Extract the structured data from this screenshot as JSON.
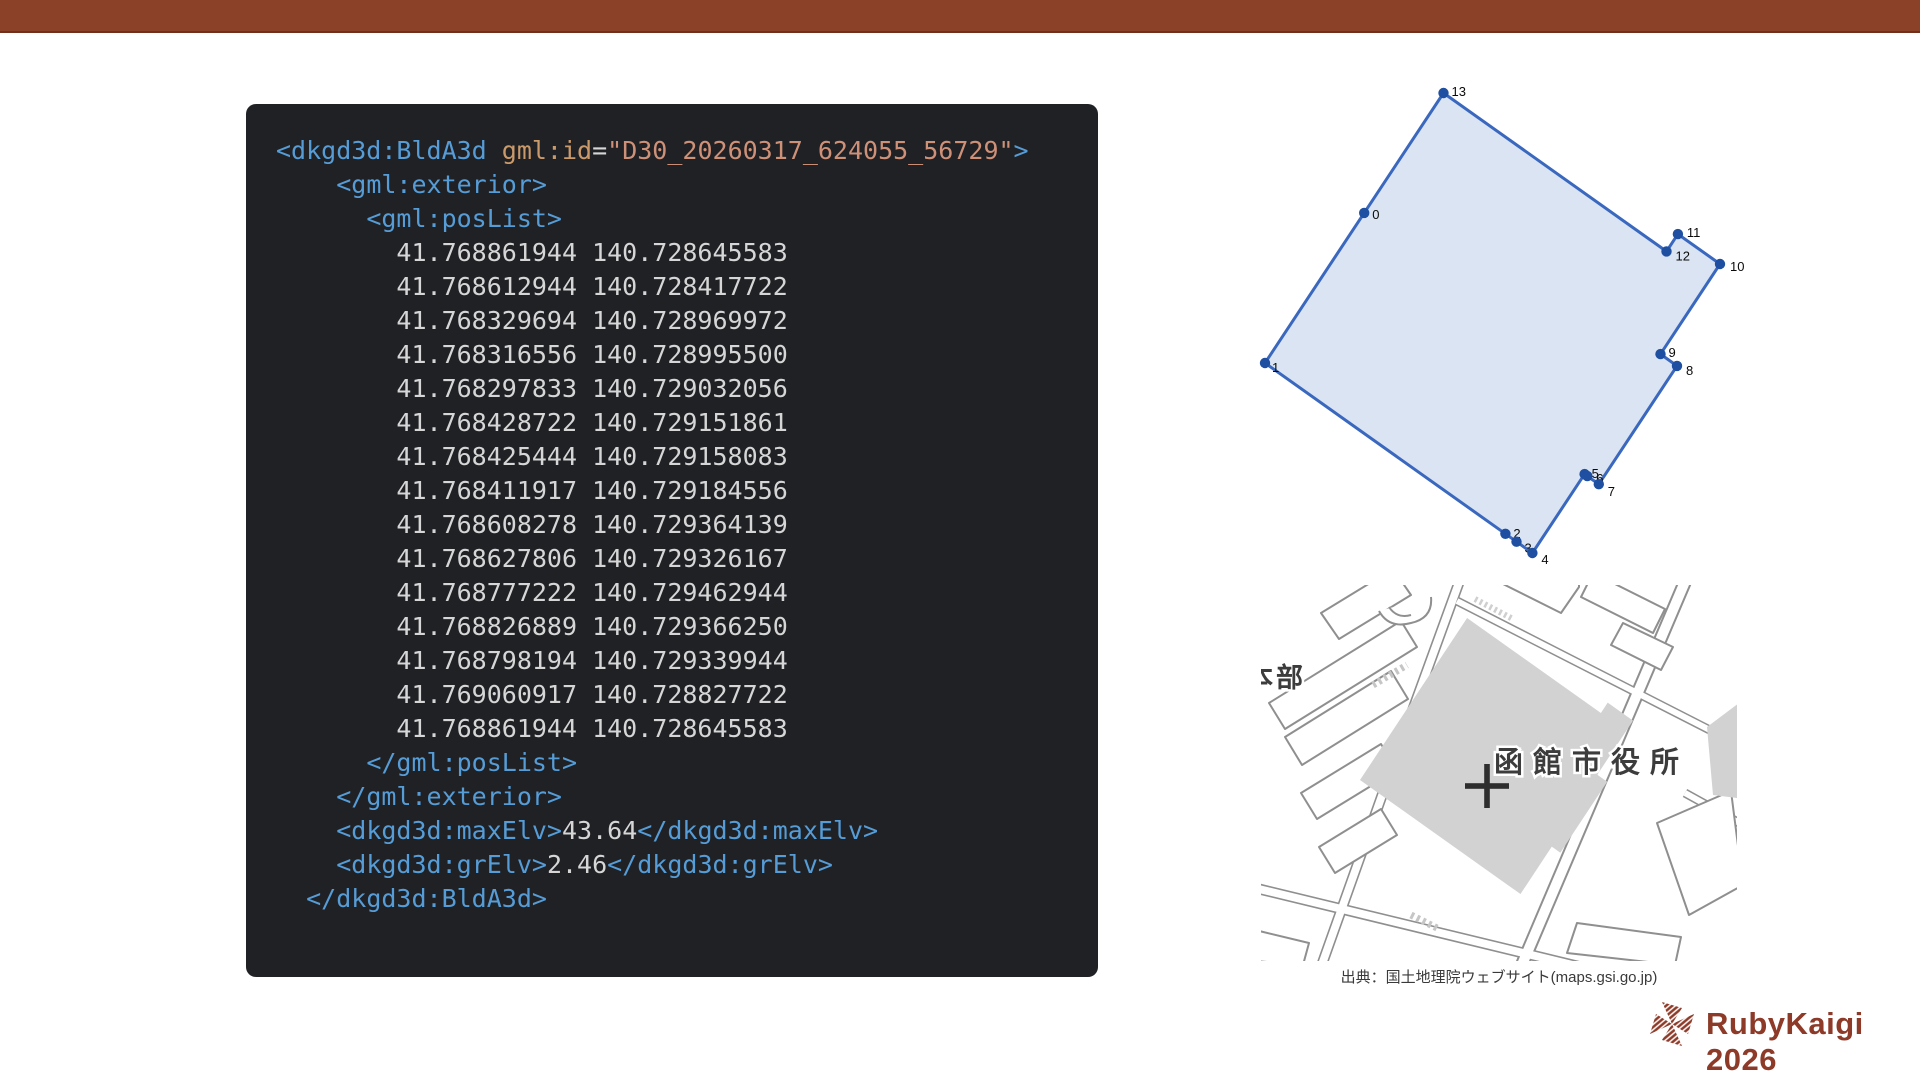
{
  "slide": {
    "background": "#FFFFFF",
    "top_bar_color": "#8B4127",
    "top_bar_edge_color": "#72301C"
  },
  "code_block": {
    "background": "#1F2125",
    "token_colors": {
      "tag": "#569CD6",
      "attr_name": "#CB9A6B",
      "string": "#CE9178",
      "plain": "#D6D6D6"
    },
    "lines": [
      [
        [
          "tag",
          "<dkgd3d:BldA3d"
        ],
        [
          "pl",
          " "
        ],
        [
          "attr",
          "gml:id"
        ],
        [
          "pl",
          "="
        ],
        [
          "str",
          "\"D30_20260317_624055_56729\""
        ],
        [
          "tag",
          ">"
        ]
      ],
      [
        [
          "pl",
          "    "
        ],
        [
          "tag",
          "<gml:exterior>"
        ]
      ],
      [
        [
          "pl",
          "      "
        ],
        [
          "tag",
          "<gml:posList>"
        ]
      ],
      [
        [
          "pl",
          "        41.768861944 140.728645583"
        ]
      ],
      [
        [
          "pl",
          "        41.768612944 140.728417722"
        ]
      ],
      [
        [
          "pl",
          "        41.768329694 140.728969972"
        ]
      ],
      [
        [
          "pl",
          "        41.768316556 140.728995500"
        ]
      ],
      [
        [
          "pl",
          "        41.768297833 140.729032056"
        ]
      ],
      [
        [
          "pl",
          "        41.768428722 140.729151861"
        ]
      ],
      [
        [
          "pl",
          "        41.768425444 140.729158083"
        ]
      ],
      [
        [
          "pl",
          "        41.768411917 140.729184556"
        ]
      ],
      [
        [
          "pl",
          "        41.768608278 140.729364139"
        ]
      ],
      [
        [
          "pl",
          "        41.768627806 140.729326167"
        ]
      ],
      [
        [
          "pl",
          "        41.768777222 140.729462944"
        ]
      ],
      [
        [
          "pl",
          "        41.768826889 140.729366250"
        ]
      ],
      [
        [
          "pl",
          "        41.768798194 140.729339944"
        ]
      ],
      [
        [
          "pl",
          "        41.769060917 140.728827722"
        ]
      ],
      [
        [
          "pl",
          "        41.768861944 140.728645583"
        ]
      ],
      [
        [
          "pl",
          "      "
        ],
        [
          "tag",
          "</gml:posList>"
        ]
      ],
      [
        [
          "pl",
          "    "
        ],
        [
          "tag",
          "</gml:exterior>"
        ]
      ],
      [
        [
          "pl",
          "    "
        ],
        [
          "tag",
          "<dkgd3d:maxElv>"
        ],
        [
          "pl",
          "43.64"
        ],
        [
          "tag",
          "</dkgd3d:maxElv>"
        ]
      ],
      [
        [
          "pl",
          "    "
        ],
        [
          "tag",
          "<dkgd3d:grElv>"
        ],
        [
          "pl",
          "2.46"
        ],
        [
          "tag",
          "</dkgd3d:grElv>"
        ]
      ],
      [
        [
          "pl",
          "  "
        ],
        [
          "tag",
          "</dkgd3d:BldA3d>"
        ]
      ]
    ]
  },
  "chart_data": {
    "type": "polygon",
    "title": "",
    "description": "Building footprint polygon plotted from gml:posList (latitude vs longitude), vertices numbered 0-13, closed ring",
    "stroke_color": "#3A68BE",
    "fill_color": "#DAE4F2",
    "dot_color": "#1E4FA1",
    "max_elv": "43.64",
    "gr_elv": "2.46",
    "vertices": [
      {
        "label": "0",
        "lat": 41.768861944,
        "lon": 140.728645583
      },
      {
        "label": "1",
        "lat": 41.768612944,
        "lon": 140.728417722
      },
      {
        "label": "2",
        "lat": 41.768329694,
        "lon": 140.728969972
      },
      {
        "label": "3",
        "lat": 41.768316556,
        "lon": 140.7289955
      },
      {
        "label": "4",
        "lat": 41.768297833,
        "lon": 140.729032056
      },
      {
        "label": "5",
        "lat": 41.768428722,
        "lon": 140.729151861
      },
      {
        "label": "6",
        "lat": 41.768425444,
        "lon": 140.729158083
      },
      {
        "label": "7",
        "lat": 41.768411917,
        "lon": 140.729184556
      },
      {
        "label": "8",
        "lat": 41.768608278,
        "lon": 140.729364139
      },
      {
        "label": "9",
        "lat": 41.768627806,
        "lon": 140.729326167
      },
      {
        "label": "10",
        "lat": 41.768777222,
        "lon": 140.729462944
      },
      {
        "label": "11",
        "lat": 41.768826889,
        "lon": 140.72936625
      },
      {
        "label": "12",
        "lat": 41.768798194,
        "lon": 140.729339944
      },
      {
        "label": "13",
        "lat": 41.769060917,
        "lon": 140.728827722
      }
    ]
  },
  "map": {
    "building_label": "函館市役所",
    "left_edge_label": "本部",
    "building_fill": "#D2D2D2",
    "road_outline_color": "#8F8F8F",
    "marker": "cross-marker",
    "caption": "出典：国土地理院ウェブサイト(maps.gsi.go.jp)"
  },
  "footer": {
    "logo_text": "RubyKaigi 2026",
    "brand_color": "#8D3A28"
  }
}
